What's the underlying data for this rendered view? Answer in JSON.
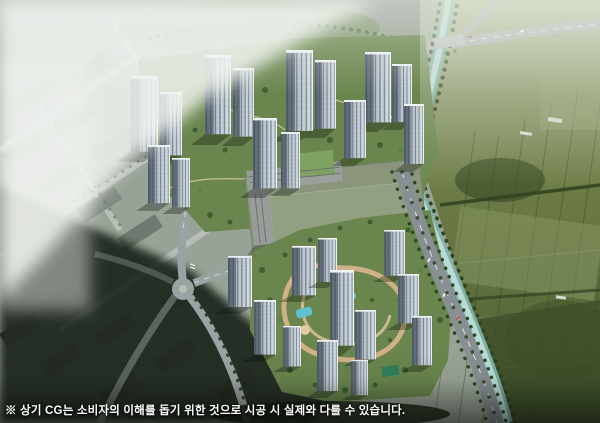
{
  "caption": {
    "text": "※ 상기 CG는 소비자의 이해를 돕기 위한 것으로 시공 시 실제와 다를 수 있습니다."
  },
  "colors": {
    "city_base": "#98a296",
    "haze": "#f1f4f0",
    "river": "#7fb2a9",
    "river_core": "#bfe0da",
    "farmland_dark": "#4c5c33",
    "farmland_light": "#8c9b68",
    "greenery": "#6a854d",
    "tree_dark": "#3c602f",
    "tree_light": "#558447",
    "road": "#878f93",
    "road_minor": "#9aa3a3",
    "tower_facade_light": "#d8e0e6",
    "tower_facade_dark": "#76828e",
    "tower_roof": "#eef2f5",
    "shadow_zone": "#0d130d",
    "garden_path": "#dcb68c",
    "pool": "#5fc0d2",
    "school_roof": "#7fa263",
    "school_field": "#8a957c",
    "caption_text": "#ffffff"
  }
}
